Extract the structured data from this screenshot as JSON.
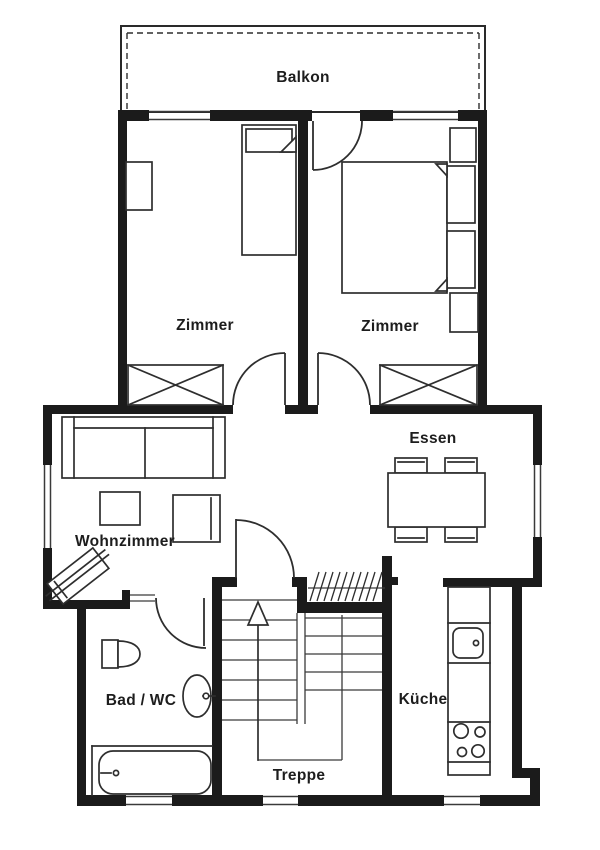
{
  "plan": {
    "type": "apartment-floor-plan",
    "rooms": {
      "balcony": {
        "label": "Balkon"
      },
      "bedroom_left": {
        "label": "Zimmer"
      },
      "bedroom_right": {
        "label": "Zimmer"
      },
      "dining": {
        "label": "Essen"
      },
      "living": {
        "label": "Wohnzimmer"
      },
      "bath": {
        "label": "Bad / WC"
      },
      "stairs": {
        "label": "Treppe"
      },
      "kitchen": {
        "label": "Küche"
      }
    },
    "colors": {
      "wall": "#1b1b1b",
      "line": "#2e2e2e",
      "background": "#ffffff"
    }
  }
}
